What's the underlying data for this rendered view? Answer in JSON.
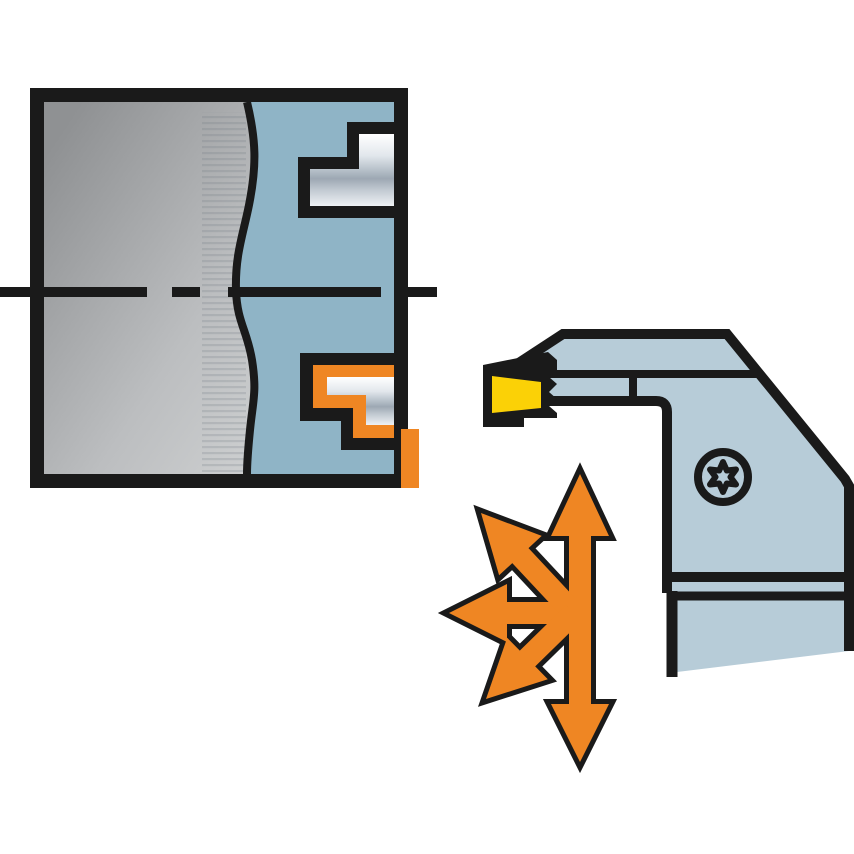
{
  "illustration": {
    "kind": "machining-application-diagram",
    "workpiece": {
      "regions": [
        "raw-material-gray",
        "machined-section-blue"
      ],
      "profiles": [
        "upper-stepped-groove",
        "lower-stepped-groove-highlighted"
      ],
      "centerline": "dash-dot"
    },
    "tool": {
      "parts": [
        "holder-body",
        "blade",
        "cutting-insert",
        "torx-clamp-screw"
      ],
      "icons": {
        "screw": "torx-screw-icon",
        "arrows": "multi-direction-feed-arrows-icon"
      },
      "arrow_directions": [
        "up",
        "down",
        "left",
        "up-left",
        "down-left"
      ]
    },
    "colors": {
      "outline_black": "#1a1a1a",
      "workpiece_blue": "#8fb4c6",
      "tool_blue": "#b7ccd8",
      "accent_orange": "#ef8623",
      "insert_yellow": "#fbd106",
      "background_white": "#ffffff"
    }
  }
}
